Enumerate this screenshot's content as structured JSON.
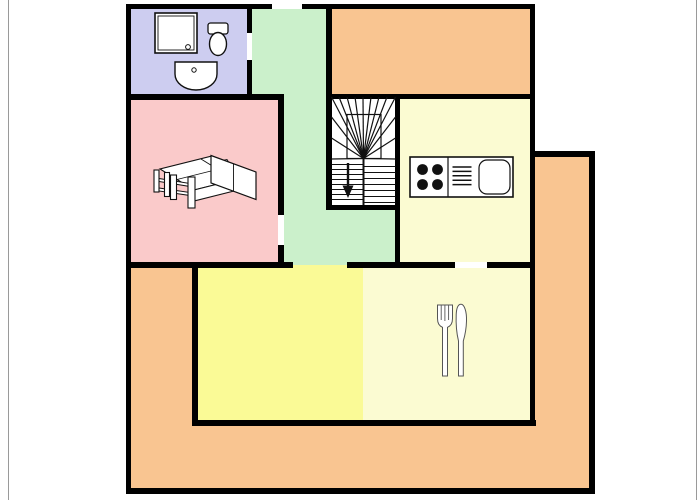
{
  "meta": {
    "type": "floor-plan",
    "width": 700,
    "height": 500
  },
  "palette": {
    "wall": "#000000",
    "outside": "#ffffff",
    "page_border": "#9a9a9a",
    "bathroom": "#cdcdf0",
    "hallway": "#cbf0cb",
    "bedroom": "#facaca",
    "terrace": "#f9c591",
    "kitchen": "#fbfbd2",
    "living": "#fafa96",
    "stairwell": "#ffffff",
    "fixture_stroke": "#111111",
    "cutlery_stroke": "#555555"
  },
  "rooms": [
    {
      "name": "room-bathroom",
      "color": "bathroom",
      "rects": [
        [
          131,
          9,
          116,
          85
        ]
      ]
    },
    {
      "name": "room-hallway",
      "color": "hallway",
      "rects": [
        [
          252,
          9,
          74,
          90
        ],
        [
          284,
          94,
          42,
          118
        ],
        [
          284,
          210,
          111,
          54
        ]
      ]
    },
    {
      "name": "room-bedroom",
      "color": "bedroom",
      "rects": [
        [
          131,
          100,
          147,
          162
        ]
      ]
    },
    {
      "name": "room-upper-balcony",
      "color": "terrace",
      "rects": [
        [
          332,
          9,
          198,
          85
        ]
      ]
    },
    {
      "name": "stairwell",
      "color": "stairwell",
      "rects": [
        [
          331,
          99,
          64,
          106
        ]
      ]
    },
    {
      "name": "room-kitchen",
      "color": "kitchen",
      "rects": [
        [
          400,
          99,
          130,
          163
        ]
      ]
    },
    {
      "name": "room-living",
      "color": "living",
      "rects": [
        [
          198,
          264,
          165,
          156
        ]
      ]
    },
    {
      "name": "room-dining",
      "color": "kitchen",
      "rects": [
        [
          363,
          264,
          167,
          156
        ]
      ]
    },
    {
      "name": "room-terrace",
      "color": "terrace",
      "rects": [
        [
          131,
          268,
          61,
          220
        ],
        [
          131,
          426,
          460,
          62
        ],
        [
          535,
          157,
          56,
          331
        ]
      ]
    }
  ],
  "walls": [
    [
      127,
      4,
      145,
      5
    ],
    [
      302,
      4,
      233,
      5
    ],
    [
      126,
      4,
      5,
      490
    ],
    [
      126,
      488,
      469,
      6
    ],
    [
      530,
      4,
      5,
      422
    ],
    [
      535,
      151,
      60,
      6
    ],
    [
      589,
      151,
      6,
      343
    ],
    [
      247,
      4,
      5,
      96
    ],
    [
      127,
      94,
      155,
      6
    ],
    [
      278,
      94,
      6,
      174
    ],
    [
      326,
      4,
      6,
      206
    ],
    [
      326,
      94,
      209,
      5
    ],
    [
      395,
      99,
      5,
      163
    ],
    [
      331,
      205,
      64,
      5
    ],
    [
      127,
      262,
      166,
      6
    ],
    [
      347,
      262,
      108,
      6
    ],
    [
      487,
      262,
      48,
      6
    ],
    [
      192,
      262,
      6,
      164
    ],
    [
      192,
      420,
      344,
      6
    ]
  ],
  "door_gaps": [
    {
      "name": "gap-entrance-door",
      "rect": [
        272,
        4,
        30,
        5
      ],
      "color": "outside"
    },
    {
      "name": "gap-bathroom-door",
      "rect": [
        247,
        33,
        5,
        27
      ],
      "color": "outside"
    },
    {
      "name": "gap-bedroom-door",
      "rect": [
        278,
        215,
        6,
        30
      ],
      "color": "outside"
    },
    {
      "name": "gap-kitchen-door",
      "rect": [
        455,
        262,
        32,
        6
      ],
      "color": "outside"
    },
    {
      "name": "gap-living-opening-top",
      "rect": [
        293,
        262,
        54,
        2.5
      ],
      "color": "hallway"
    },
    {
      "name": "gap-living-opening-bottom",
      "rect": [
        293,
        264.5,
        54,
        3.5
      ],
      "color": "living"
    }
  ],
  "fixtures": [
    {
      "name": "shower-icon",
      "shapes": [
        {
          "t": "rect",
          "x": 155,
          "y": 13,
          "w": 42,
          "h": 40,
          "sw": 1.6,
          "fill": "#ffffff"
        },
        {
          "t": "rect",
          "x": 158,
          "y": 16,
          "w": 36,
          "h": 34,
          "sw": 0.9
        },
        {
          "t": "circle",
          "cx": 188,
          "cy": 47,
          "r": 2.4,
          "sw": 1,
          "fill": "#ffffff"
        }
      ]
    },
    {
      "name": "toilet-icon",
      "shapes": [
        {
          "t": "rect",
          "x": 208,
          "y": 23,
          "w": 20,
          "h": 11,
          "rx": 2.5,
          "sw": 1.3,
          "fill": "#ffffff"
        },
        {
          "t": "ellipse",
          "cx": 218,
          "cy": 44,
          "rx": 8.5,
          "ry": 11.5,
          "sw": 1.4,
          "fill": "#ffffff"
        }
      ]
    },
    {
      "name": "washbasin-icon",
      "shapes": [
        {
          "t": "path",
          "d": "M175,62 h42 v12 a21,16 0 0 1 -42,0 z",
          "sw": 1.4,
          "fill": "#ffffff"
        },
        {
          "t": "circle",
          "cx": 194,
          "cy": 70,
          "r": 2.2,
          "sw": 1,
          "fill": "#ffffff"
        }
      ]
    },
    {
      "name": "bed-icon",
      "shapes": [
        {
          "t": "poly",
          "pts": "194,190 160,169 212,156 246,177",
          "fill": "#ffffff",
          "sw": 1.1
        },
        {
          "t": "poly",
          "pts": "194,190 246,177 246,188 194,201",
          "fill": "#ffffff",
          "sw": 1.1
        },
        {
          "t": "line",
          "x1": 177,
          "y1": 179.5,
          "x2": 229,
          "y2": 166.5,
          "sw": 0.9
        },
        {
          "t": "line",
          "x1": 201,
          "y1": 159,
          "x2": 235,
          "y2": 180,
          "sw": 0.9
        },
        {
          "t": "poly",
          "pts": "216,162 227,159.5 231,166 220,168.5",
          "fill": "#ffffff",
          "sw": 0.9
        },
        {
          "t": "poly",
          "pts": "225,170 236,167.5 240,174 229,176.5",
          "fill": "#ffffff",
          "sw": 0.9
        },
        {
          "t": "poly",
          "pts": "159,178.5 190,183.5 190,186.5 159,181.5",
          "fill": "#ffffff",
          "sw": 1
        },
        {
          "t": "poly",
          "pts": "159,188 190,192.5 190,195.5 159,191",
          "fill": "#ffffff",
          "sw": 1
        },
        {
          "t": "rect",
          "x": 154,
          "y": 170,
          "w": 5,
          "h": 22,
          "sw": 1.1,
          "fill": "#ffffff"
        },
        {
          "t": "rect",
          "x": 164.5,
          "y": 172.5,
          "w": 5,
          "h": 24,
          "sw": 1.1,
          "fill": "#ffffff"
        },
        {
          "t": "rect",
          "x": 170.5,
          "y": 175,
          "w": 6,
          "h": 24.5,
          "sw": 1.1,
          "fill": "#ffffff"
        },
        {
          "t": "rect",
          "x": 188,
          "y": 177,
          "w": 7,
          "h": 31,
          "sw": 1.1,
          "fill": "#ffffff"
        },
        {
          "t": "poly",
          "pts": "211,155.5 256,172 256,199.5 211,183",
          "fill": "#ffffff",
          "sw": 1.2
        },
        {
          "t": "line",
          "x1": 233.5,
          "y1": 163.8,
          "x2": 233.5,
          "y2": 191.2,
          "sw": 0.9
        }
      ]
    },
    {
      "name": "stairs-icon",
      "shapes": [
        {
          "t": "rect",
          "x": 347,
          "y": 114.5,
          "w": 34,
          "h": 44,
          "sw": 1.2
        },
        {
          "t": "line",
          "x1": 363.5,
          "y1": 158.5,
          "x2": 331.5,
          "y2": 159,
          "sw": 1.2
        },
        {
          "t": "line",
          "x1": 363.5,
          "y1": 158.5,
          "x2": 331.5,
          "y2": 138,
          "sw": 1.2
        },
        {
          "t": "line",
          "x1": 363.5,
          "y1": 158.5,
          "x2": 331.5,
          "y2": 117,
          "sw": 1.2
        },
        {
          "t": "line",
          "x1": 363.5,
          "y1": 158.5,
          "x2": 331.5,
          "y2": 97,
          "sw": 1.2
        },
        {
          "t": "line",
          "x1": 363.5,
          "y1": 158.5,
          "x2": 339,
          "y2": 97,
          "sw": 1.2
        },
        {
          "t": "line",
          "x1": 363.5,
          "y1": 158.5,
          "x2": 347,
          "y2": 97,
          "sw": 1.2
        },
        {
          "t": "line",
          "x1": 363.5,
          "y1": 158.5,
          "x2": 355,
          "y2": 97,
          "sw": 1.2
        },
        {
          "t": "line",
          "x1": 363.5,
          "y1": 158.5,
          "x2": 363,
          "y2": 97,
          "sw": 1.2
        },
        {
          "t": "line",
          "x1": 363.5,
          "y1": 158.5,
          "x2": 371,
          "y2": 97,
          "sw": 1.2
        },
        {
          "t": "line",
          "x1": 363.5,
          "y1": 158.5,
          "x2": 379,
          "y2": 97,
          "sw": 1.2
        },
        {
          "t": "line",
          "x1": 363.5,
          "y1": 158.5,
          "x2": 387,
          "y2": 97,
          "sw": 1.2
        },
        {
          "t": "line",
          "x1": 363.5,
          "y1": 158.5,
          "x2": 395.5,
          "y2": 97,
          "sw": 1.2
        },
        {
          "t": "line",
          "x1": 363.5,
          "y1": 158.5,
          "x2": 395.5,
          "y2": 117,
          "sw": 1.2
        },
        {
          "t": "line",
          "x1": 363.5,
          "y1": 158.5,
          "x2": 395.5,
          "y2": 138,
          "sw": 1.2
        },
        {
          "t": "line",
          "x1": 363.5,
          "y1": 158.5,
          "x2": 395.5,
          "y2": 159,
          "sw": 1.2
        },
        {
          "t": "line",
          "x1": 331.5,
          "y1": 164.5,
          "x2": 363.5,
          "y2": 164.5,
          "sw": 1.1
        },
        {
          "t": "line",
          "x1": 331.5,
          "y1": 169.5,
          "x2": 363.5,
          "y2": 169.5,
          "sw": 1.1
        },
        {
          "t": "line",
          "x1": 331.5,
          "y1": 174.5,
          "x2": 363.5,
          "y2": 174.5,
          "sw": 1.1
        },
        {
          "t": "line",
          "x1": 331.5,
          "y1": 179.5,
          "x2": 363.5,
          "y2": 179.5,
          "sw": 1.1
        },
        {
          "t": "line",
          "x1": 331.5,
          "y1": 184.5,
          "x2": 363.5,
          "y2": 184.5,
          "sw": 1.1
        },
        {
          "t": "line",
          "x1": 331.5,
          "y1": 189.5,
          "x2": 363.5,
          "y2": 189.5,
          "sw": 1.1
        },
        {
          "t": "line",
          "x1": 331.5,
          "y1": 194.5,
          "x2": 363.5,
          "y2": 194.5,
          "sw": 1.1
        },
        {
          "t": "line",
          "x1": 331.5,
          "y1": 199.5,
          "x2": 363.5,
          "y2": 199.5,
          "sw": 1.1
        },
        {
          "t": "line",
          "x1": 363.5,
          "y1": 166.5,
          "x2": 395.5,
          "y2": 166.5,
          "sw": 1.1
        },
        {
          "t": "line",
          "x1": 363.5,
          "y1": 172.5,
          "x2": 395.5,
          "y2": 172.5,
          "sw": 1.1
        },
        {
          "t": "line",
          "x1": 363.5,
          "y1": 178.5,
          "x2": 395.5,
          "y2": 178.5,
          "sw": 1.1
        },
        {
          "t": "line",
          "x1": 363.5,
          "y1": 184.5,
          "x2": 395.5,
          "y2": 184.5,
          "sw": 1.1
        },
        {
          "t": "line",
          "x1": 363.5,
          "y1": 190.5,
          "x2": 395.5,
          "y2": 190.5,
          "sw": 1.1
        },
        {
          "t": "line",
          "x1": 363.5,
          "y1": 196.5,
          "x2": 395.5,
          "y2": 196.5,
          "sw": 1.1
        },
        {
          "t": "line",
          "x1": 363.5,
          "y1": 202.5,
          "x2": 395.5,
          "y2": 202.5,
          "sw": 1.1
        },
        {
          "t": "line",
          "x1": 363.5,
          "y1": 158.5,
          "x2": 363.5,
          "y2": 205,
          "sw": 2
        }
      ]
    },
    {
      "name": "down-arrow-icon",
      "shapes": [
        {
          "t": "line",
          "x1": 348,
          "y1": 163,
          "x2": 348,
          "y2": 187,
          "sw": 2.4
        },
        {
          "t": "poly",
          "pts": "342.5,185.5 353.5,185.5 348,198",
          "fill": "#111111",
          "sw": 0
        }
      ]
    },
    {
      "name": "kitchen-counter-icon",
      "shapes": [
        {
          "t": "rect",
          "x": 410,
          "y": 157,
          "w": 103,
          "h": 40,
          "sw": 1.6,
          "fill": "#ffffff"
        },
        {
          "t": "line",
          "x1": 448,
          "y1": 157,
          "x2": 448,
          "y2": 197,
          "sw": 1.2
        },
        {
          "t": "circle",
          "cx": 422.5,
          "cy": 169.5,
          "r": 5.4,
          "fill": "#111111",
          "sw": 0
        },
        {
          "t": "circle",
          "cx": 437.5,
          "cy": 169.5,
          "r": 5.4,
          "fill": "#111111",
          "sw": 0
        },
        {
          "t": "circle",
          "cx": 422.5,
          "cy": 184.5,
          "r": 5.4,
          "fill": "#111111",
          "sw": 0
        },
        {
          "t": "circle",
          "cx": 437.5,
          "cy": 184.5,
          "r": 5.4,
          "fill": "#111111",
          "sw": 0
        },
        {
          "t": "line",
          "x1": 452.5,
          "y1": 167,
          "x2": 471.5,
          "y2": 167,
          "sw": 1.5
        },
        {
          "t": "line",
          "x1": 452.5,
          "y1": 171.4,
          "x2": 471.5,
          "y2": 171.4,
          "sw": 1.5
        },
        {
          "t": "line",
          "x1": 452.5,
          "y1": 175.8,
          "x2": 471.5,
          "y2": 175.8,
          "sw": 1.5
        },
        {
          "t": "line",
          "x1": 452.5,
          "y1": 180.2,
          "x2": 471.5,
          "y2": 180.2,
          "sw": 1.5
        },
        {
          "t": "line",
          "x1": 452.5,
          "y1": 184.6,
          "x2": 471.5,
          "y2": 184.6,
          "sw": 1.5
        },
        {
          "t": "rect",
          "x": 479,
          "y": 160,
          "w": 31,
          "h": 34,
          "rx": 8,
          "sw": 1.2,
          "fill": "#ffffff"
        }
      ]
    },
    {
      "name": "fork-icon",
      "shapes": [
        {
          "t": "path",
          "d": "M437.5,305 h15 v13.5 c0,4.5 -2,7.6 -5,8.8 V376 h-5 V327.3 c-3,-1.2 -5,-4.3 -5,-8.8 Z",
          "fill": "#ffffff",
          "sw": 1,
          "sc": "#555555"
        },
        {
          "t": "line",
          "x1": 441.2,
          "y1": 305.5,
          "x2": 441.2,
          "y2": 320,
          "sw": 0.9,
          "sc": "#555555"
        },
        {
          "t": "line",
          "x1": 444.9,
          "y1": 305.5,
          "x2": 444.9,
          "y2": 321,
          "sw": 0.9,
          "sc": "#555555"
        },
        {
          "t": "line",
          "x1": 448.6,
          "y1": 305.5,
          "x2": 448.6,
          "y2": 320,
          "sw": 0.9,
          "sc": "#555555"
        }
      ]
    },
    {
      "name": "knife-icon",
      "shapes": [
        {
          "t": "path",
          "d": "M458.5,376 V341 C456.8,334 455.8,324 456.2,314.5 C456.5,308 458.3,304.3 461,304.3 C464.2,304.3 466.8,311 466.5,321 C466.3,329 464.8,336 463.3,341 V376 Z",
          "fill": "#ffffff",
          "sw": 1,
          "sc": "#555555"
        }
      ]
    }
  ]
}
